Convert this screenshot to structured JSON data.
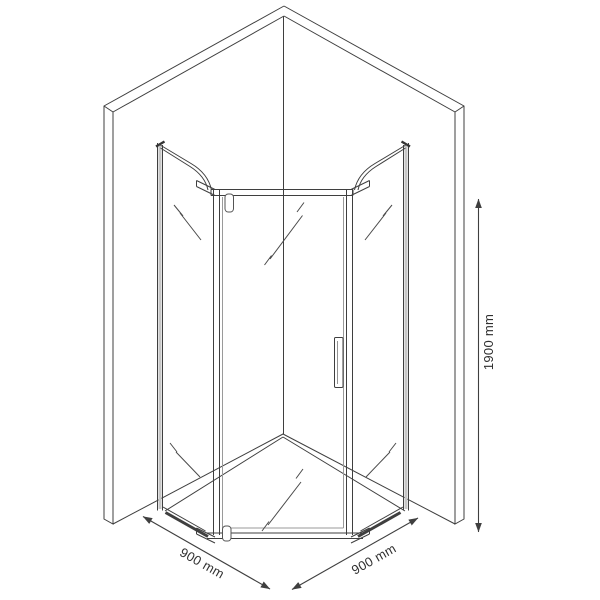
{
  "drawing": {
    "subject": "corner-shower-enclosure-technical-drawing",
    "dimension_labels": {
      "width_left": "900 mm",
      "width_right": "900 mm",
      "height": "1900 mm"
    },
    "dimensions": {
      "width_left_mm": 900,
      "width_right_mm": 900,
      "height_mm": 1900,
      "unit": "mm"
    },
    "colors": {
      "line": "#3f3f3f",
      "light_line": "#c6c6c6",
      "background": "#ffffff"
    }
  }
}
